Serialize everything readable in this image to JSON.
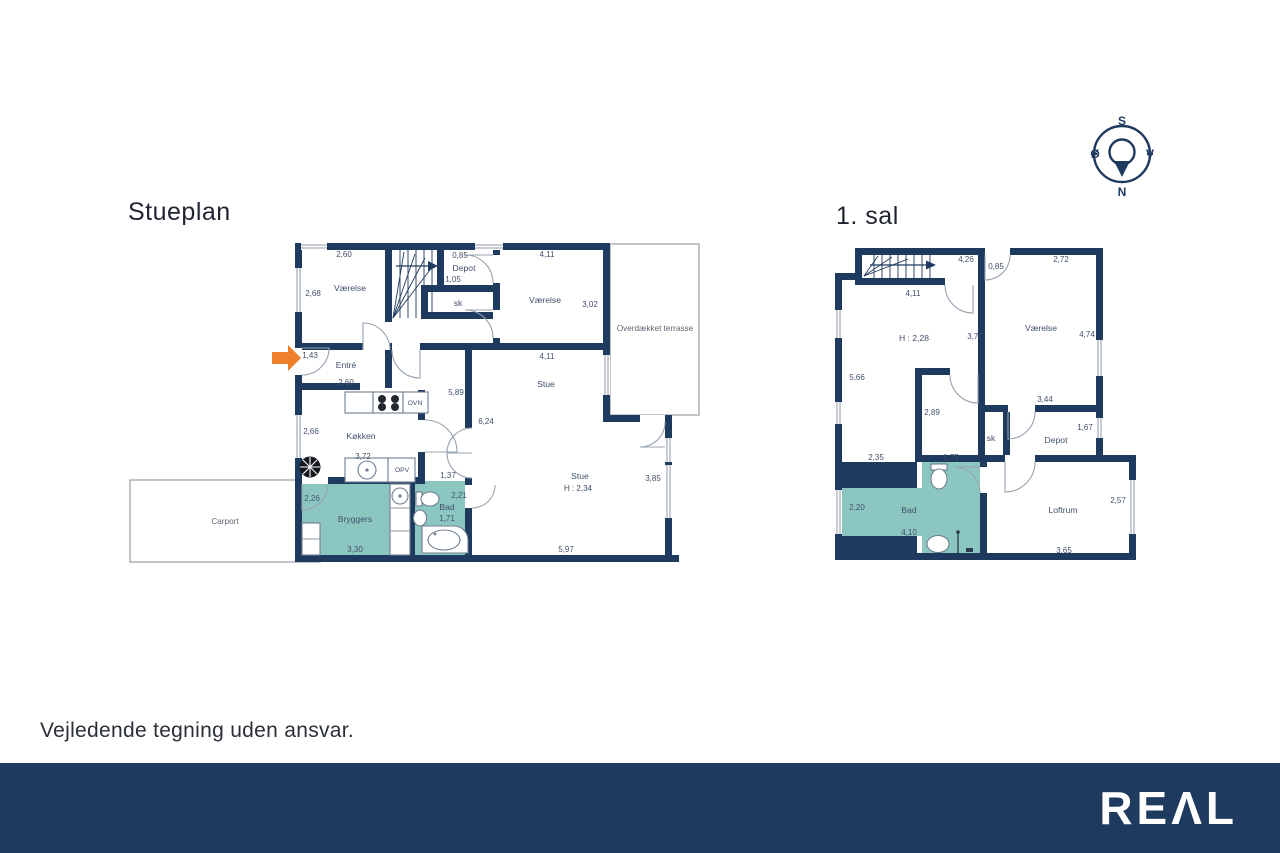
{
  "plans": {
    "stueplan": {
      "title": "Stueplan",
      "vaerelse1": {
        "name": "Værelse",
        "width": "2,60",
        "depth": "2,68"
      },
      "depot": {
        "name": "Depot",
        "width": "0,85",
        "depth": "1,05"
      },
      "sk": {
        "name": "sk"
      },
      "vaerelse2": {
        "name": "Værelse",
        "width": "4,11",
        "depth": "3,02"
      },
      "terrasse": {
        "name": "Overdækket terrasse"
      },
      "entre": {
        "name": "Entré",
        "door": "1,43",
        "width": "2,60"
      },
      "koekken": {
        "name": "Køkken",
        "depth": "2,66",
        "width": "3,72",
        "ovn": "OVN",
        "opv": "OPV"
      },
      "gang": {
        "dim1": "5,89",
        "dim2": "6,24",
        "dim3": "1,37"
      },
      "stue_top": {
        "name": "Stue",
        "width": "4,11"
      },
      "stue": {
        "name": "Stue",
        "ceiling_height": "H : 2,34",
        "depth": "3,85",
        "width": "5,97"
      },
      "bryggers": {
        "name": "Bryggers",
        "depth": "2,26",
        "width": "3,30"
      },
      "bad": {
        "name": "Bad",
        "depth": "2,21",
        "width": "1,71"
      },
      "carport": {
        "name": "Carport"
      }
    },
    "sal1": {
      "title": "1. sal",
      "trappe": {
        "width": "4,26",
        "door": "0,85",
        "bottom": "4,11"
      },
      "repos": {
        "ceiling_height": "H : 2,28",
        "depth": "5,66",
        "width": "2,35"
      },
      "vaerelse": {
        "name": "Værelse",
        "width": "2,72",
        "depth": "4,74",
        "bottom": "3,44"
      },
      "gang": {
        "wall": "3,77",
        "dim1": "2,89",
        "dim2": "1,75"
      },
      "sk": {
        "name": "sk"
      },
      "depot": {
        "name": "Depot",
        "depth": "1,67"
      },
      "bad": {
        "name": "Bad",
        "depth": "2,20",
        "width": "4,10"
      },
      "loftrum": {
        "name": "Loftrum",
        "depth": "2,57",
        "width": "3,65"
      }
    }
  },
  "compass": {
    "north": "N",
    "south": "S",
    "east": "Ø",
    "west": "V"
  },
  "footer": {
    "disclaimer": "Vejledende tegning uden ansvar.",
    "logo": "REΛL"
  },
  "colors": {
    "wall": "#1e3a5f",
    "wet_room": "#8cc6c1",
    "arrow": "#ee7f2b",
    "banner": "#1e3a5f"
  }
}
